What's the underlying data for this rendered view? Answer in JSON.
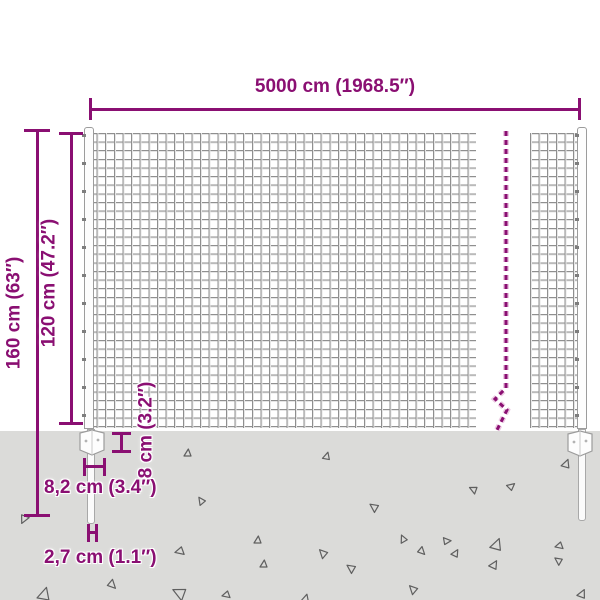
{
  "title": "wire-mesh-fence-dimension-diagram",
  "colors": {
    "accent": "#8a0f72",
    "ground": "#dbdbd9",
    "mesh_line": "#8f8f8f",
    "post_fill": "#fdfdfd",
    "triangle_stroke": "#5f5f5f"
  },
  "dimensions": {
    "width_label": "5000 cm (1968.5″)",
    "total_height_label": "160 cm (63″)",
    "mesh_height_label": "120 cm (47.2″)",
    "bottom_gap_label": "8 cm (3.2″)",
    "bracket_width_label": "8,2 cm (3.4″)",
    "post_width_label": "2,7 cm (1.1″)"
  },
  "ground": {
    "triangles": [
      {
        "x": 20,
        "y": 516,
        "s": 8,
        "r": 200
      },
      {
        "x": 184,
        "y": 449,
        "s": 7,
        "r": 0
      },
      {
        "x": 323,
        "y": 452,
        "s": 7,
        "r": 10
      },
      {
        "x": 562,
        "y": 459,
        "s": 8,
        "r": 15
      },
      {
        "x": 197,
        "y": 497,
        "s": 7,
        "r": 320
      },
      {
        "x": 369,
        "y": 503,
        "s": 8,
        "r": 300
      },
      {
        "x": 469,
        "y": 486,
        "s": 7,
        "r": 290
      },
      {
        "x": 508,
        "y": 482,
        "s": 7,
        "r": 45
      },
      {
        "x": 175,
        "y": 548,
        "s": 8,
        "r": 250
      },
      {
        "x": 254,
        "y": 536,
        "s": 7,
        "r": 0
      },
      {
        "x": 318,
        "y": 549,
        "s": 8,
        "r": 310
      },
      {
        "x": 399,
        "y": 535,
        "s": 7,
        "r": 330
      },
      {
        "x": 452,
        "y": 549,
        "s": 7,
        "r": 25
      },
      {
        "x": 491,
        "y": 538,
        "s": 11,
        "r": 15
      },
      {
        "x": 554,
        "y": 557,
        "s": 7,
        "r": 300
      },
      {
        "x": 38,
        "y": 587,
        "s": 12,
        "r": 10
      },
      {
        "x": 109,
        "y": 581,
        "s": 8,
        "r": 130
      },
      {
        "x": 172,
        "y": 587,
        "s": 12,
        "r": 290
      },
      {
        "x": 222,
        "y": 592,
        "s": 7,
        "r": 250
      },
      {
        "x": 260,
        "y": 560,
        "s": 7,
        "r": 0
      },
      {
        "x": 302,
        "y": 594,
        "s": 7,
        "r": 10
      },
      {
        "x": 346,
        "y": 564,
        "s": 8,
        "r": 300
      },
      {
        "x": 408,
        "y": 585,
        "s": 8,
        "r": 310
      },
      {
        "x": 419,
        "y": 548,
        "s": 7,
        "r": 130
      },
      {
        "x": 444,
        "y": 537,
        "s": 7,
        "r": 80
      },
      {
        "x": 490,
        "y": 560,
        "s": 8,
        "r": 25
      },
      {
        "x": 555,
        "y": 543,
        "s": 7,
        "r": 250
      },
      {
        "x": 578,
        "y": 589,
        "s": 8,
        "r": 20
      }
    ]
  }
}
